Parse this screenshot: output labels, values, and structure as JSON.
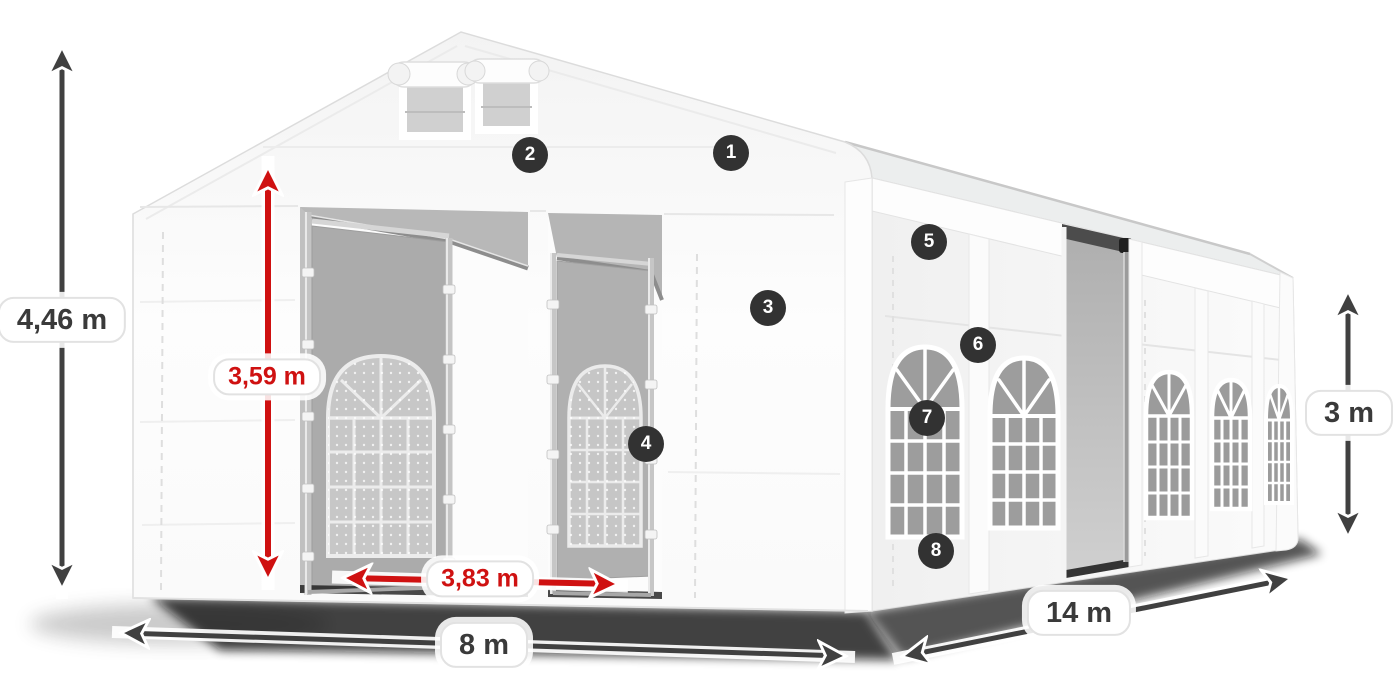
{
  "diagram": {
    "subject": "Party tent 8 x 14 m dimension diagram",
    "colors": {
      "accent_red": "#cf1111",
      "arrow_gray": "#404040",
      "badge_background": "#323232",
      "pill_border": "#e2e2e2"
    },
    "dimensions": {
      "total_height": "4,46 m",
      "entrance_height": "3,59 m",
      "entrance_width": "3,83 m",
      "front_width": "8 m",
      "side_length": "14 m",
      "wall_height": "3 m"
    },
    "callouts": [
      "1",
      "2",
      "3",
      "4",
      "5",
      "6",
      "7",
      "8"
    ]
  }
}
